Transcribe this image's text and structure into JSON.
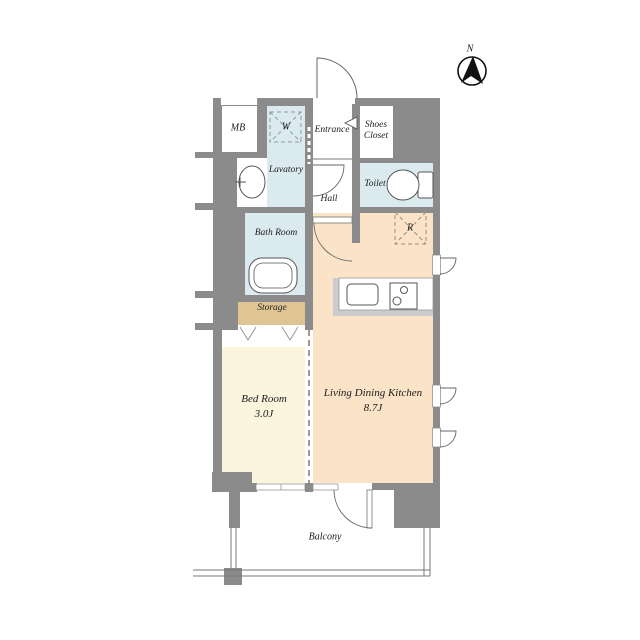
{
  "plan": {
    "compass": {
      "north_label": "N"
    },
    "rooms": {
      "mb": {
        "label": "MB"
      },
      "washing_machine": {
        "label": "W"
      },
      "lavatory": {
        "label": "Lavatory"
      },
      "entrance": {
        "label": "Entrance"
      },
      "shoes_closet": {
        "line1": "Shoes",
        "line2": "Closet"
      },
      "hall": {
        "label": "Hall"
      },
      "toilet": {
        "label": "Toilet"
      },
      "bathroom": {
        "label": "Bath Room"
      },
      "storage": {
        "label": "Storage"
      },
      "refrigerator": {
        "label": "R"
      },
      "bedroom": {
        "label": "Bed Room",
        "size": "3.0J"
      },
      "ldk": {
        "label": "Living Dining Kitchen",
        "size": "8.7J"
      },
      "balcony": {
        "label": "Balcony"
      }
    },
    "colors": {
      "wall": "#8b8b8b",
      "wet_area": "#daeaee",
      "ldk_floor": "#fae3c6",
      "bedroom_floor": "#faf5dc",
      "storage_floor": "#e0c493",
      "line": "#555555"
    }
  }
}
